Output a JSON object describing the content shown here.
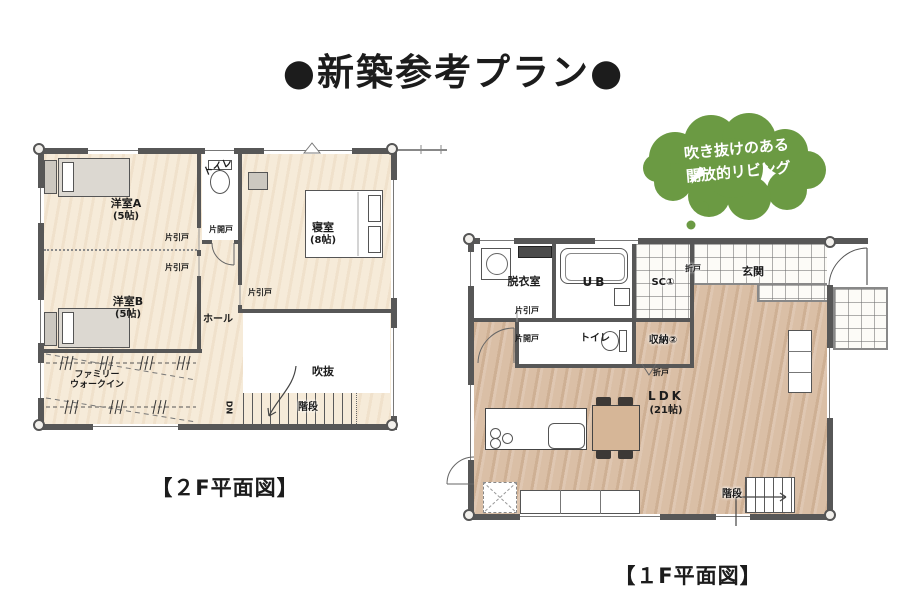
{
  "title": "●新築参考プラン●",
  "bubble": {
    "line1": "吹き抜けのある",
    "line2": "開放的リビング",
    "color": "#6b9a43"
  },
  "colors": {
    "floor_2f_cream": "#f6ebd9",
    "floor_1f_wood": "#dabfa6",
    "wall_gray": "#575757",
    "bubble_green": "#6b9a43"
  },
  "floor2f": {
    "caption": "【２F平面図】",
    "room_a_name": "洋室A",
    "room_a_size": "(5帖)",
    "room_b_name": "洋室B",
    "room_b_size": "(5帖)",
    "bedroom_name": "寝室",
    "bedroom_size": "(8帖)",
    "walkin_line1": "ファミリー",
    "walkin_line2": "ウォークイン",
    "hall": "ホール",
    "void": "吹抜",
    "stairs": "階段",
    "toilet": "トイレ",
    "down": "DN",
    "door_hinged": "片開戸",
    "door_sliding_1": "片引戸",
    "door_sliding_2": "片引戸",
    "door_sliding_3": "片引戸"
  },
  "floor1f": {
    "caption": "【１F平面図】",
    "dressing_room": "脱衣室",
    "unit_bath": "UB",
    "shoe_closet": "SC①",
    "entrance": "玄関",
    "toilet": "トイレ",
    "storage": "収納②",
    "ldk_name": "LDK",
    "ldk_size": "(21帖)",
    "stairs": "階段",
    "door_sliding": "片引戸",
    "door_hinged": "片開戸",
    "door_folding_1": "折戸",
    "door_folding_2": "折戸"
  }
}
